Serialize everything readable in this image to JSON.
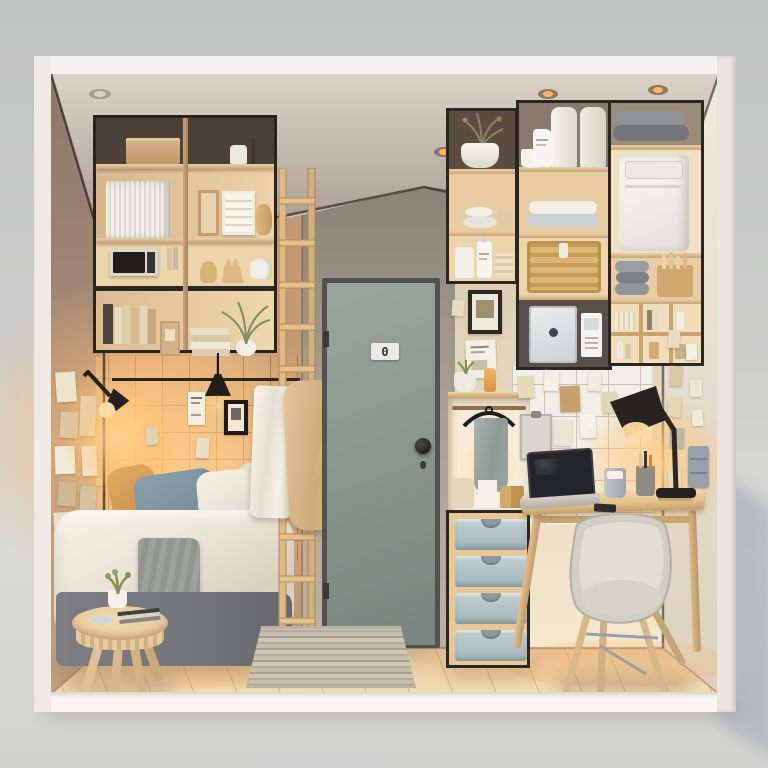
{
  "door": {
    "number_plate": "0"
  },
  "palette": {
    "background_gray": "#c9cac9",
    "frame_white": "#f3f1eb",
    "ceiling": "#c0b5aa",
    "left_wall": "#9c877a",
    "bedroom_wall_glow": "#f0c089",
    "center_wall": "#a49b90",
    "right_wall_cream": "#ecdfc6",
    "door_gray_green": "#8c9892",
    "shelf_wood": "#e2c195",
    "shelf_trim_black": "#2a2622",
    "floor_wood": "#ecd0a4",
    "bed_base_gray": "#77797c",
    "duvet_white": "#f0eadf",
    "pillow_blue": "#7e95a2",
    "pillow_accent_orange": "#d89a56",
    "throw_gray": "#9b9c99",
    "drawer_blue_gray": "#b7c5c9",
    "chair_shell": "#d2cdc5",
    "lamp_black": "#26231f",
    "warm_glow": "#ffc98c",
    "rug_stripe": "#c6bdae",
    "towel_white": "#f5f2ea",
    "robe_beige": "#dcbf94"
  }
}
